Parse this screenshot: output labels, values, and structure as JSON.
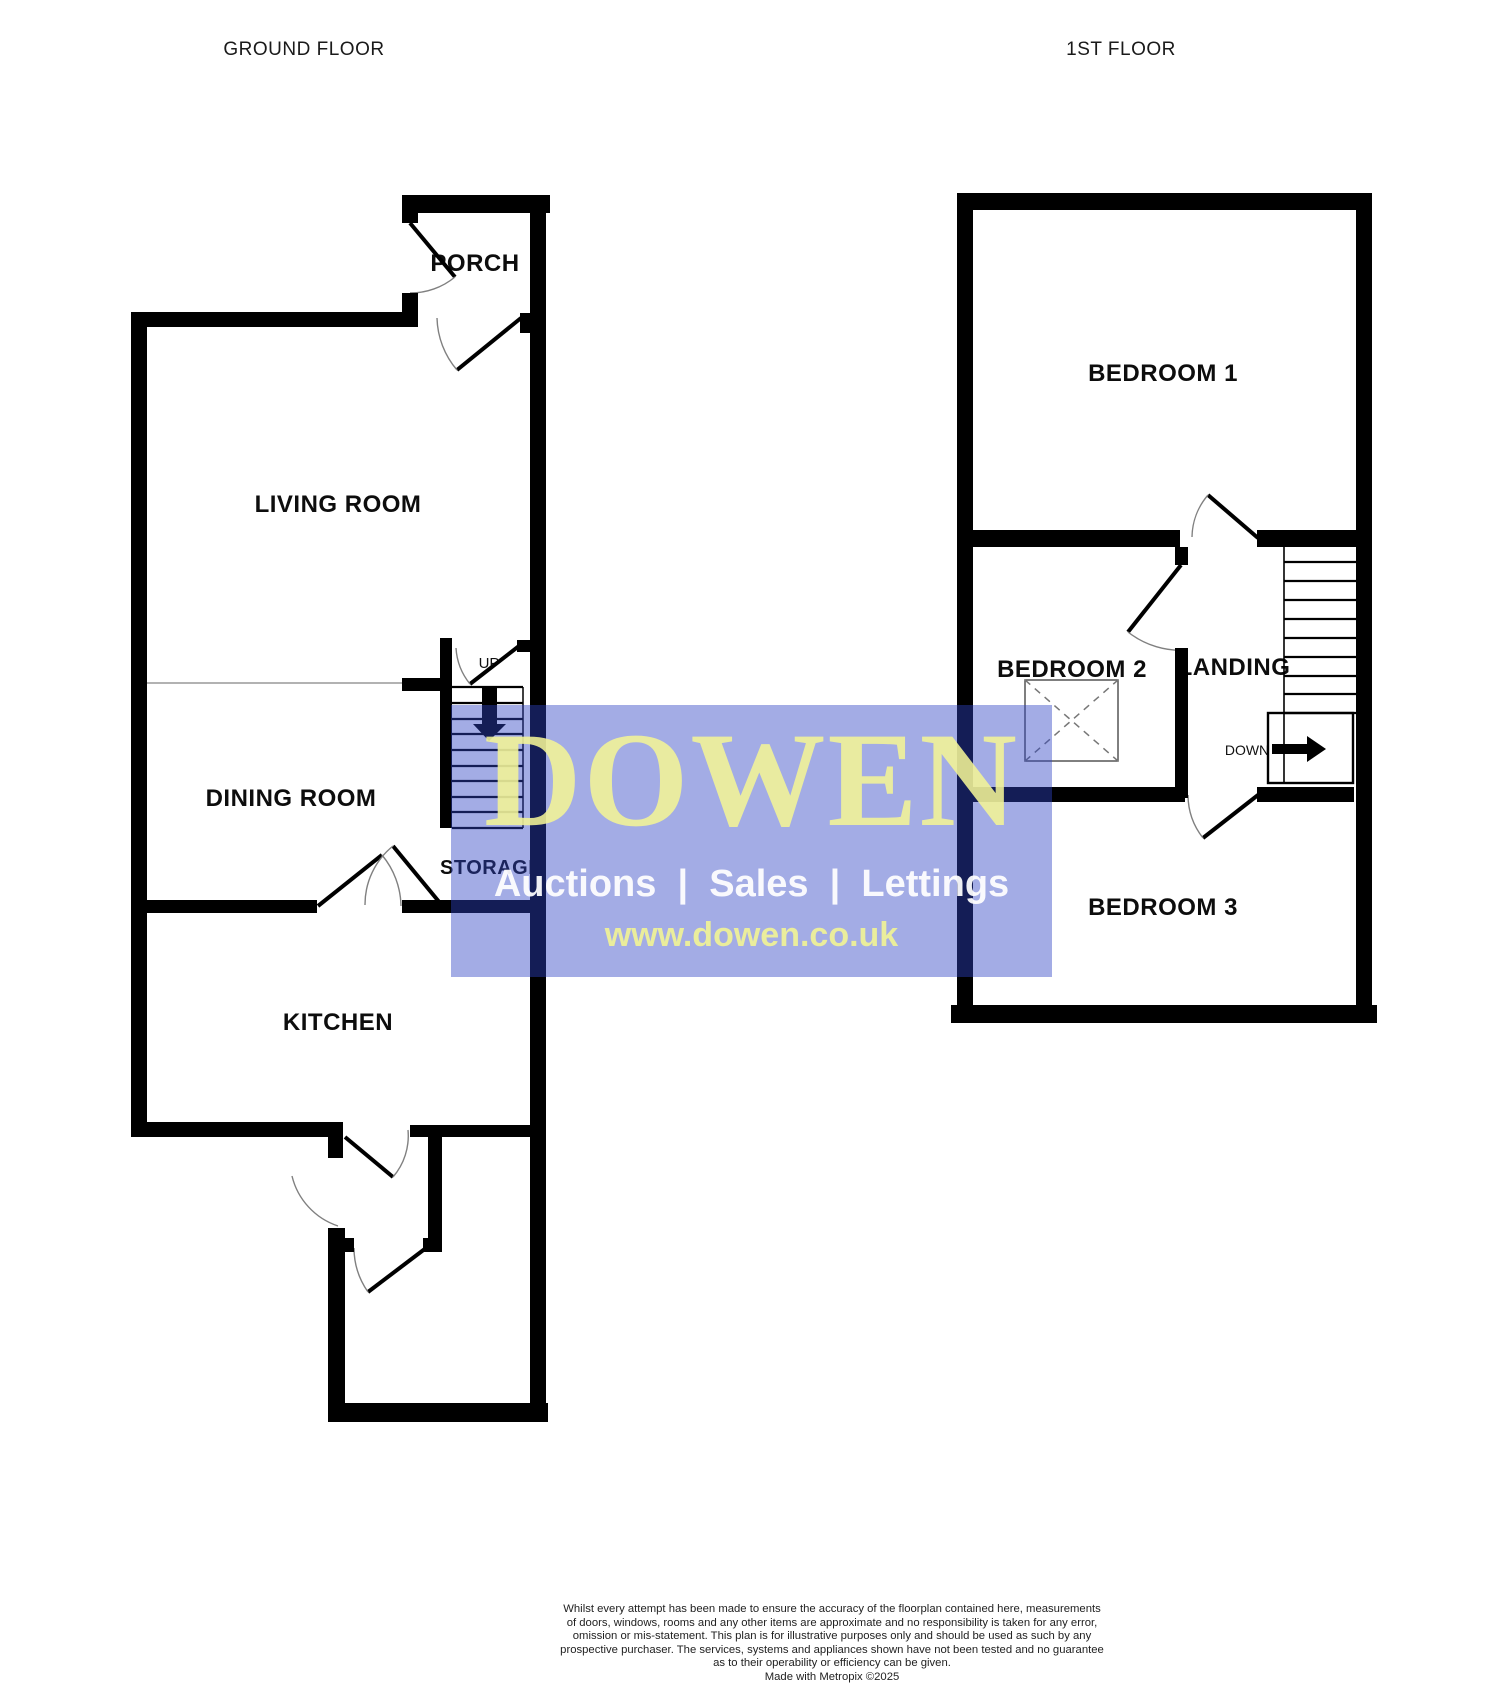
{
  "floorplan": {
    "ground": {
      "title": "GROUND FLOOR",
      "rooms": {
        "porch": "PORCH",
        "living": "LIVING ROOM",
        "dining": "DINING ROOM",
        "storage": "STORAGE",
        "kitchen": "KITCHEN"
      },
      "stair_label": "UP"
    },
    "first": {
      "title": "1ST FLOOR",
      "rooms": {
        "bedroom1": "BEDROOM 1",
        "bedroom2": "BEDROOM 2",
        "landing": "LANDING",
        "bedroom3": "BEDROOM 3"
      },
      "stair_label": "DOWN"
    }
  },
  "watermark": {
    "brand": "DOWEN",
    "services": "Auctions  |  Sales  |  Lettings",
    "website": "www.dowen.co.uk",
    "colors": {
      "panel_blue": "rgba(45,65,195,0.44)",
      "brand_yellow": "#f3f496",
      "services_white": "#ffffff",
      "website_yellow": "#f0f296"
    }
  },
  "disclaimer": {
    "lines": [
      "Whilst every attempt has been made to ensure the accuracy of the floorplan contained here, measurements",
      "of doors, windows, rooms and any other items are approximate and no responsibility is taken for any error,",
      "omission or mis-statement. This plan is for illustrative purposes only and should be used as such by any",
      "prospective purchaser. The services, systems and appliances shown have not been tested and no guarantee",
      "as to their operability or efficiency can be given.",
      "Made with Metropix ©2025"
    ]
  },
  "colors": {
    "wall_black": "#000000",
    "arc_gray": "#808080",
    "divider_gray": "#999999"
  }
}
